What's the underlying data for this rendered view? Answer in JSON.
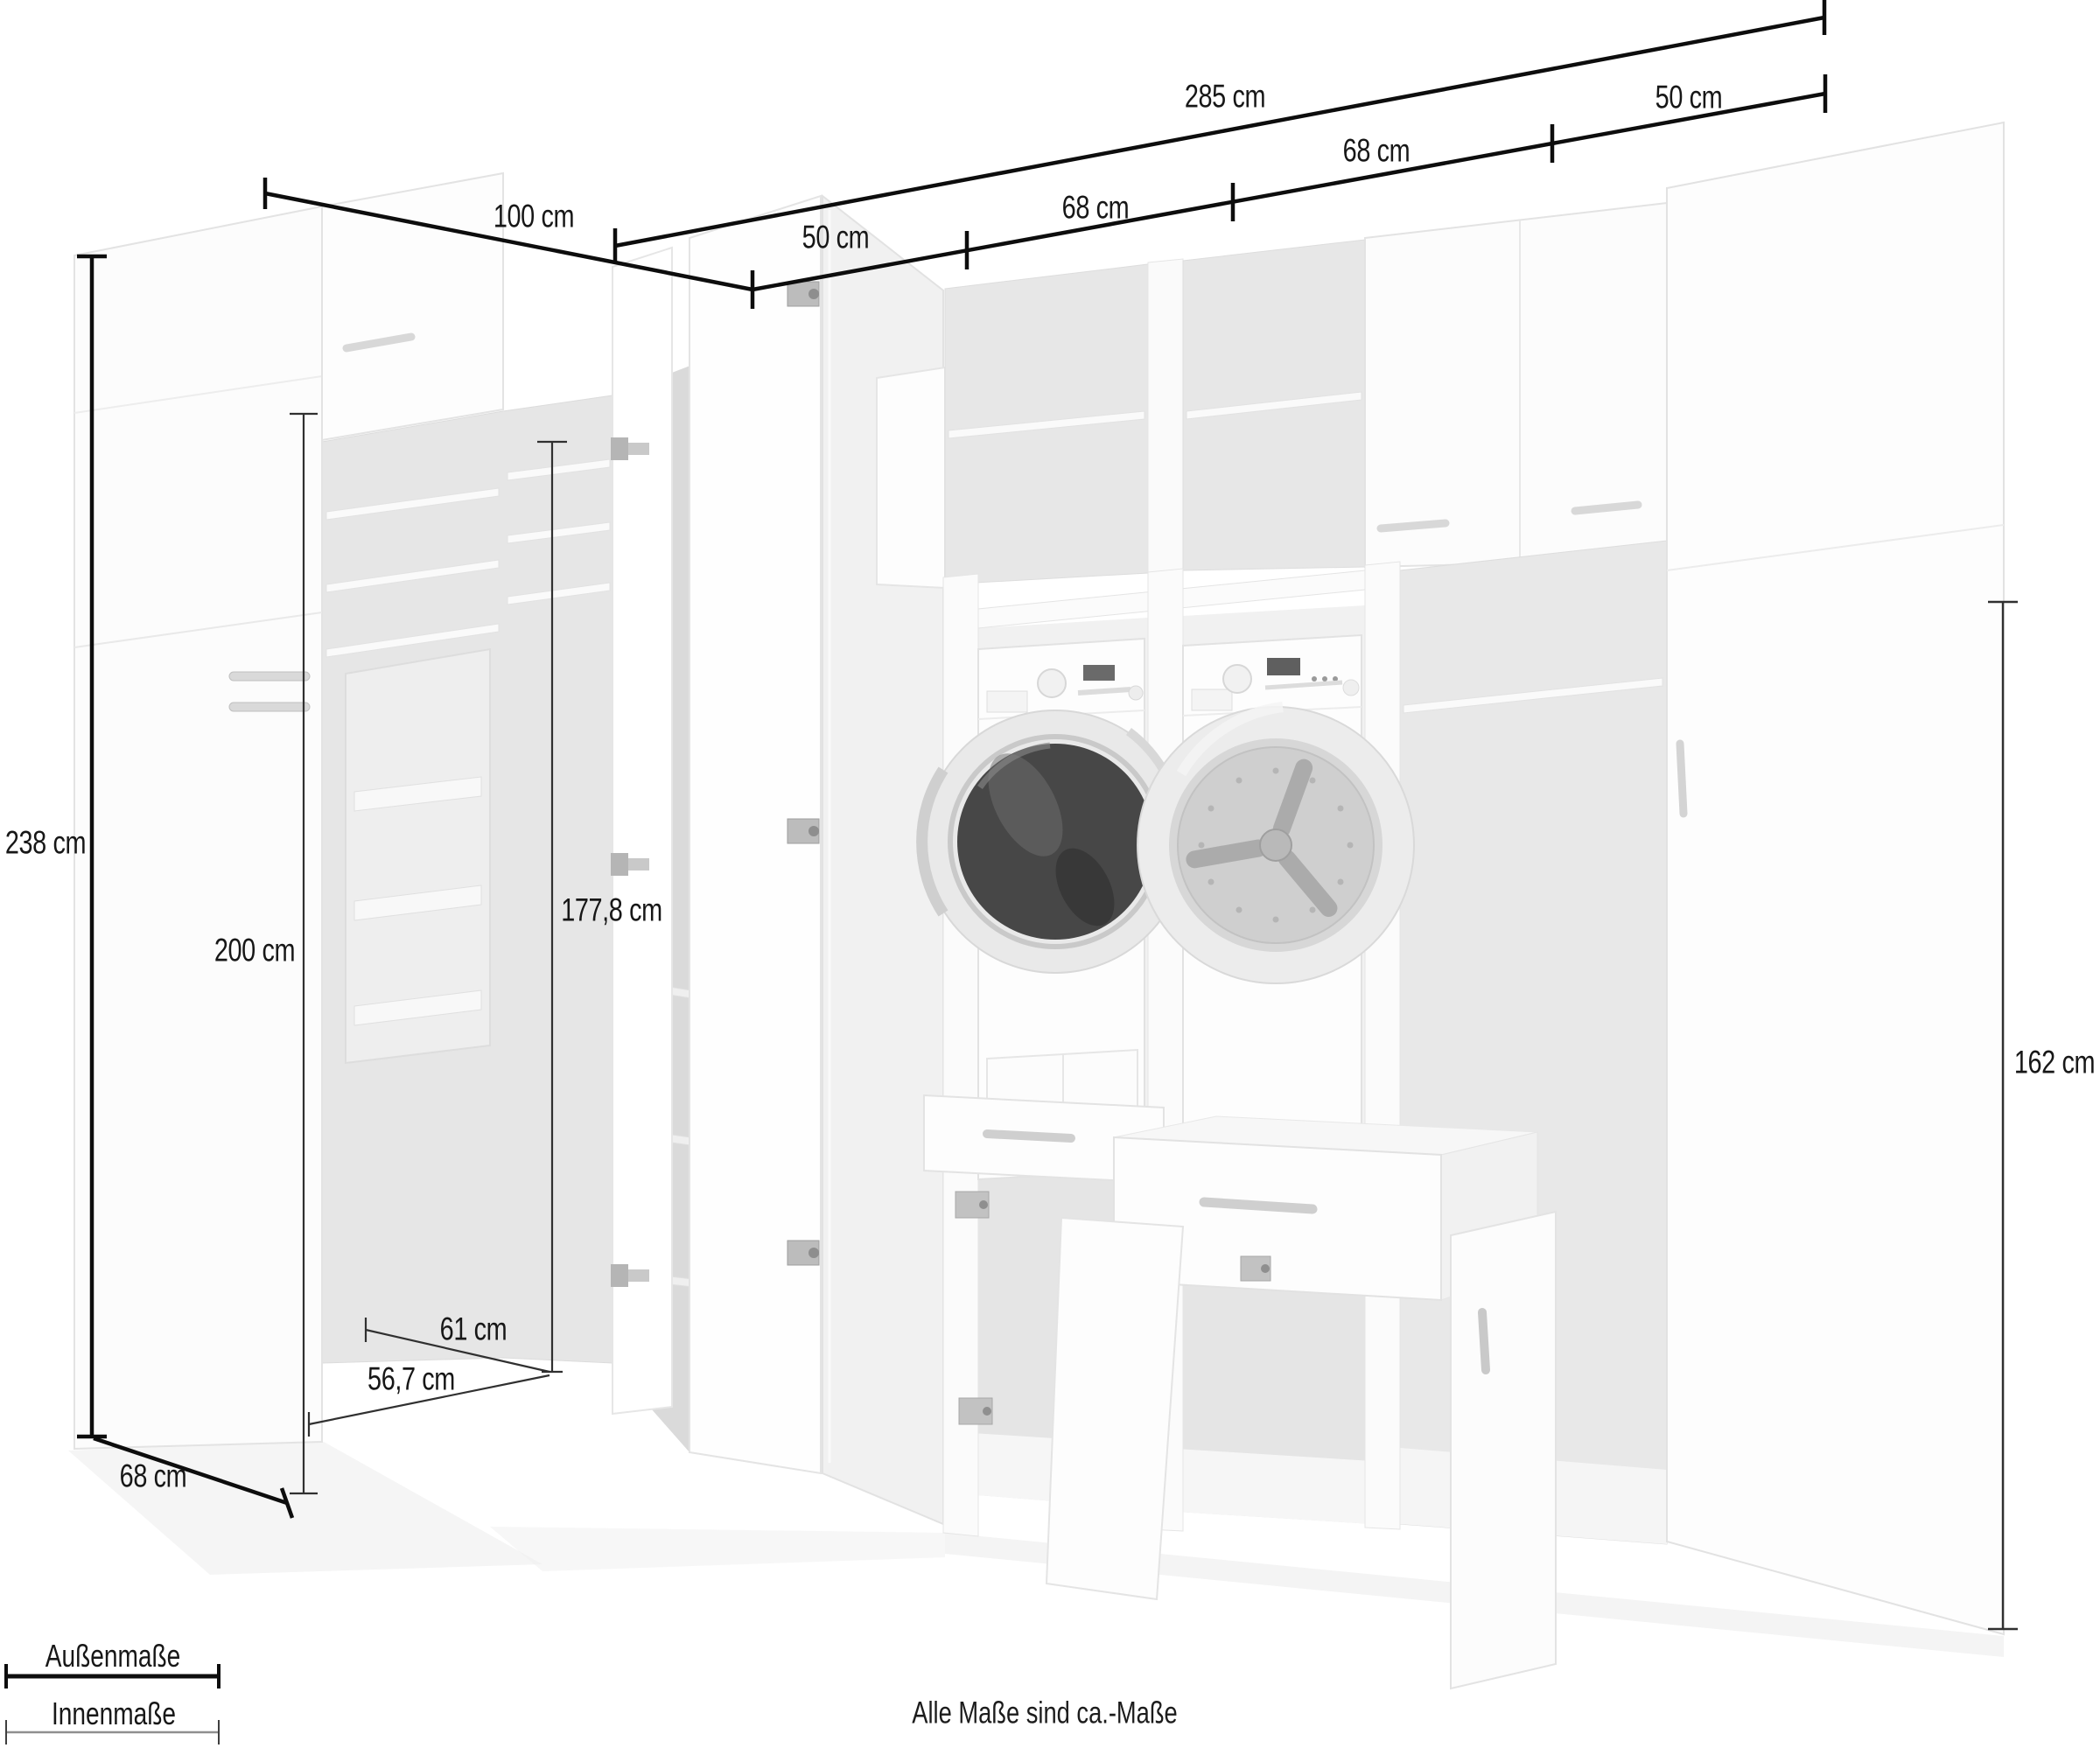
{
  "dims": [
    {
      "id": "total-width",
      "text": "285 cm",
      "type": "outer"
    },
    {
      "id": "right-return-width",
      "text": "50 cm",
      "type": "outer"
    },
    {
      "id": "segment-68-right",
      "text": "68 cm",
      "type": "outer"
    },
    {
      "id": "segment-68-left",
      "text": "68 cm",
      "type": "outer"
    },
    {
      "id": "segment-50-left",
      "text": "50 cm",
      "type": "outer"
    },
    {
      "id": "left-wing-width",
      "text": "100 cm",
      "type": "outer"
    },
    {
      "id": "outer-height",
      "text": "238 cm",
      "type": "outer"
    },
    {
      "id": "inner-height-left",
      "text": "200 cm",
      "type": "inner"
    },
    {
      "id": "inner-height-corner",
      "text": "177,8 cm",
      "type": "inner"
    },
    {
      "id": "right-inner-height",
      "text": "162 cm",
      "type": "inner"
    },
    {
      "id": "inner-depth-top",
      "text": "61 cm",
      "type": "inner"
    },
    {
      "id": "inner-depth-bottom",
      "text": "56,7 cm",
      "type": "inner"
    },
    {
      "id": "outer-depth",
      "text": "68 cm",
      "type": "outer"
    }
  ],
  "legend": {
    "outer_label": "Außenmaße",
    "inner_label": "Innenmaße"
  },
  "footer": {
    "note": "Alle Maße sind ca.-Maße"
  },
  "colors": {
    "dimension_line_outer": "#0d0d0d",
    "dimension_line_inner": "#303030",
    "legend_inner_line": "#8f8f8f",
    "cabinet_fill": "#fdfdfd",
    "cabinet_edge": "#e3e3e3",
    "interior_fill": "#e7e7e7",
    "porthole_glass_dark": "#4a4a4a",
    "drum_light": "#cfcfcf"
  }
}
